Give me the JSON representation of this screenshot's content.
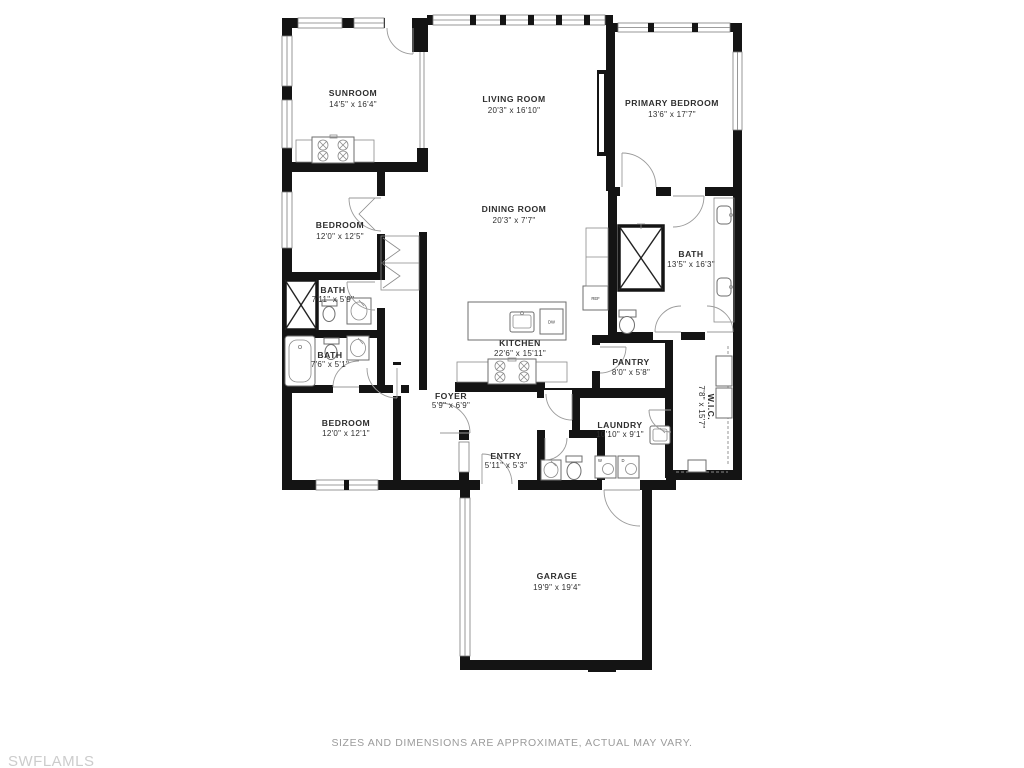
{
  "rooms": {
    "sunroom": {
      "name": "SUNROOM",
      "dims": "14'5\" x 16'4\""
    },
    "living": {
      "name": "LIVING ROOM",
      "dims": "20'3\" x 16'10\""
    },
    "primary": {
      "name": "PRIMARY BEDROOM",
      "dims": "13'6\" x 17'7\""
    },
    "bedroom_mid": {
      "name": "BEDROOM",
      "dims": "12'0\" x 12'5\""
    },
    "dining": {
      "name": "DINING ROOM",
      "dims": "20'3\" x 7'7\""
    },
    "bath_small_1": {
      "name": "BATH",
      "dims": "7'11\" x 5'9\""
    },
    "bath_primary": {
      "name": "BATH",
      "dims": "13'5\" x 16'3\""
    },
    "bath_small_2": {
      "name": "BATH",
      "dims": "7'6\" x 5'1\""
    },
    "kitchen": {
      "name": "KITCHEN",
      "dims": "22'6\" x 15'11\""
    },
    "pantry": {
      "name": "PANTRY",
      "dims": "8'0\" x 5'8\""
    },
    "bedroom_low": {
      "name": "BEDROOM",
      "dims": "12'0\" x 12'1\""
    },
    "foyer": {
      "name": "FOYER",
      "dims": "5'9\" x 6'9\""
    },
    "laundry": {
      "name": "LAUNDRY",
      "dims": "10'10\" x 9'1\""
    },
    "wic": {
      "name": "W.I.C.",
      "dims": "7'8\" x 15'7\""
    },
    "entry": {
      "name": "ENTRY",
      "dims": "5'11\" x 5'3\""
    },
    "garage": {
      "name": "GARAGE",
      "dims": "19'9\" x 19'4\""
    }
  },
  "appliances": {
    "refrigerator": "REF",
    "dishwasher": "DW",
    "washer": "W",
    "dryer": "D"
  },
  "footer": {
    "disclaimer": "SIZES AND DIMENSIONS ARE APPROXIMATE, ACTUAL MAY VARY."
  },
  "watermark": "SWFLAMLS",
  "colors": {
    "wall": "#141414",
    "fixture": "#8a8a8a",
    "label": "#2e2e2e",
    "disclaimer": "#9b9b9b",
    "watermark": "#cccccc"
  }
}
